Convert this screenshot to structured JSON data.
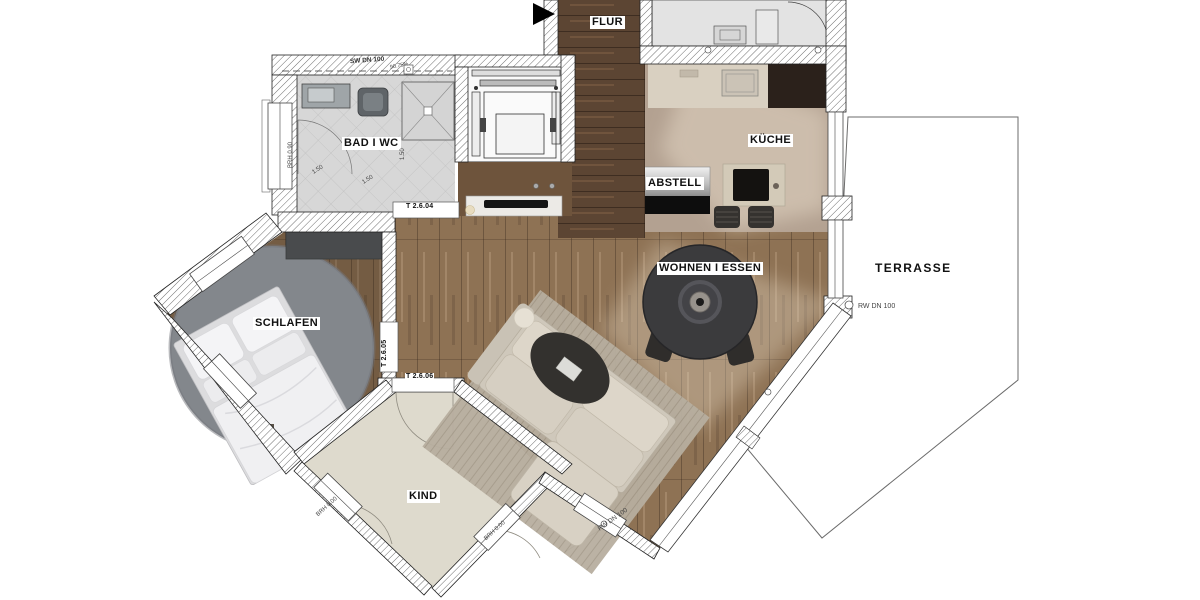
{
  "rooms": {
    "flur": "FLUR",
    "bad_wc": "BAD  I  WC",
    "kueche": "KÜCHE",
    "abstell": "ABSTELL",
    "wohnen_essen": "WOHNEN  I  ESSEN",
    "terrasse": "TERRASSE",
    "schlafen": "SCHLAFEN",
    "kind": "KIND"
  },
  "doors": {
    "bad": "T 2.6.04",
    "schlafen": "T 2.6.05",
    "kind": "T 2.6.06"
  },
  "pipes": {
    "sw": "SW DN 100",
    "sw_slope": "90.75%",
    "rw_terrace": "RW DN 100",
    "rw_south": "RW DN 100"
  },
  "sills": {
    "bad": "BRH 0.90",
    "kind_left": "BRH 0.00",
    "kind_right": "BRH 0.00"
  },
  "dims": {
    "a": "1.50",
    "b": "1.50",
    "c": "1.50"
  },
  "colors": {
    "wood_dark": "#5c4533",
    "wood_mid": "#8e7254",
    "tile_gray": "#d7d7d7",
    "kind_floor": "#dedacd",
    "rug_gray": "#83878c",
    "table_dark": "#3b3b3d",
    "marker_black": "#000000"
  }
}
